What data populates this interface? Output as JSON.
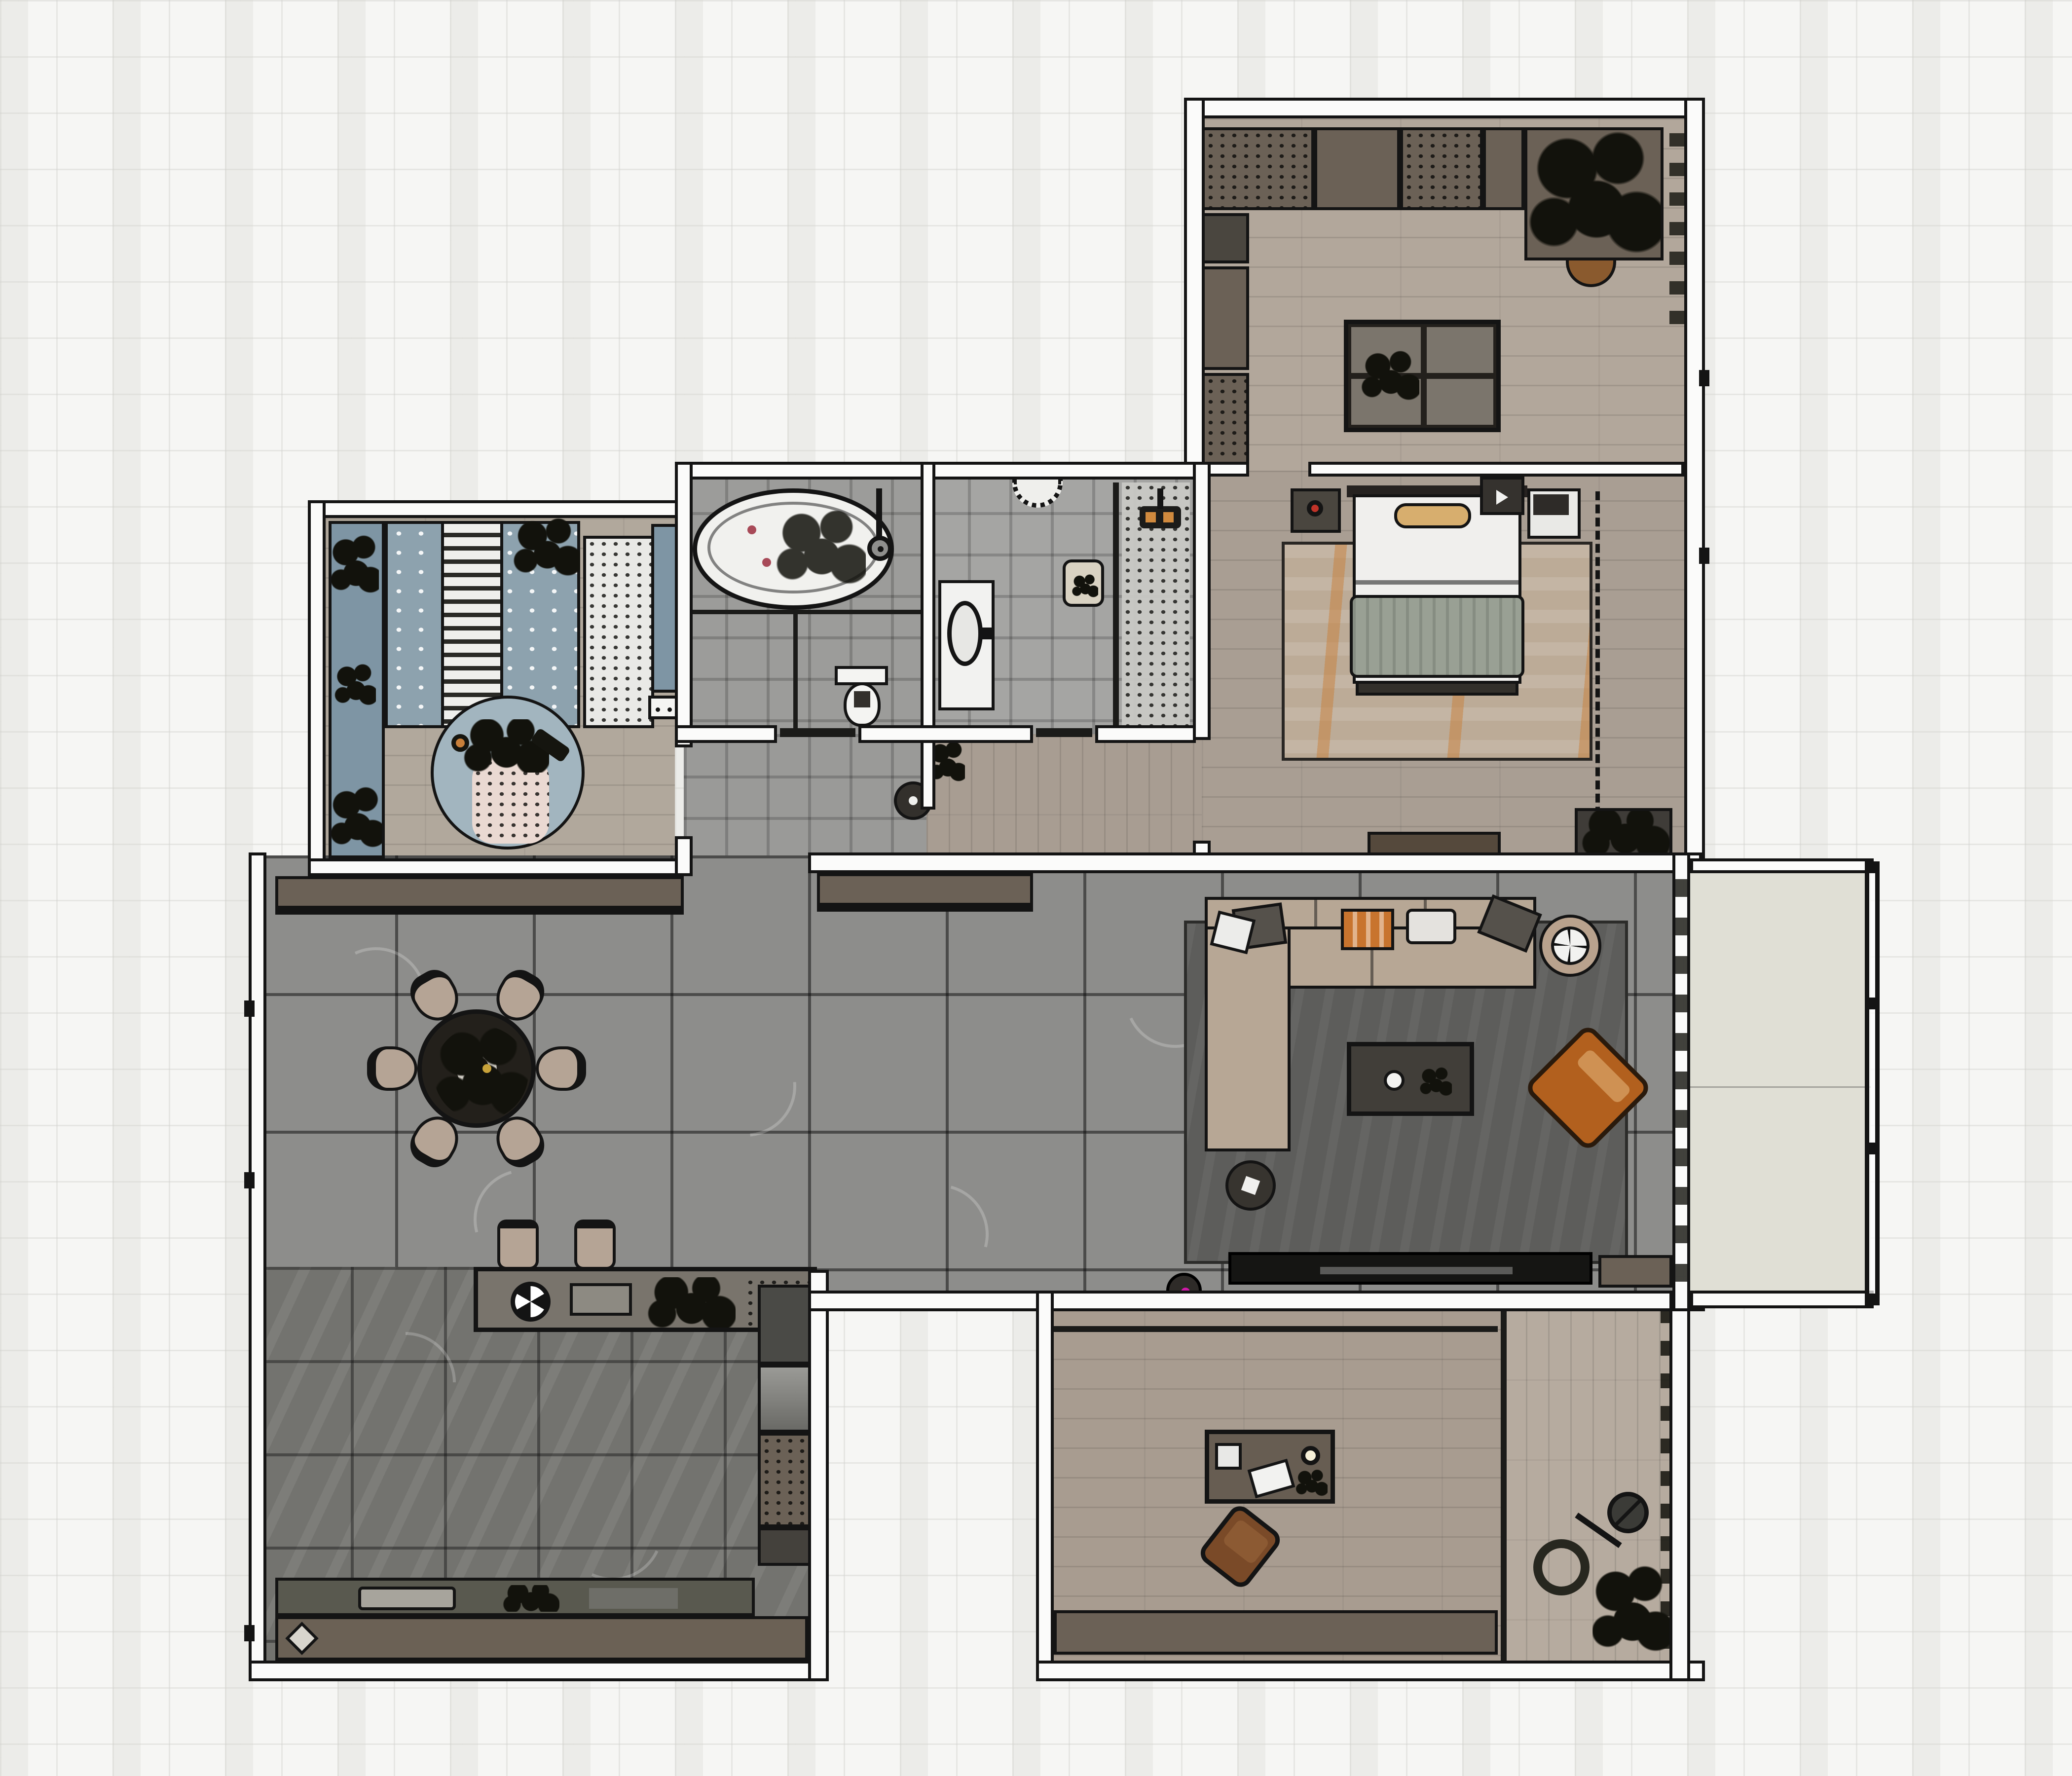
{
  "title": "apartment-floor-plan-top-view",
  "palette": {
    "background": "#f6f6f4",
    "backgroundGrid": "#e2e2de",
    "wallFill": "#fbfbfa",
    "wallLine": "#141414",
    "woodStudy": "#b2a79b",
    "woodBedroom": "#a99e93",
    "woodKids": "#b1a89c",
    "woodCorridor": "#a89d92",
    "woodTea": "#a89c90",
    "woodStrip": "#b6ab9f",
    "tileBath": "#9c9c9a",
    "tileWc": "#a5a5a3",
    "tileVestibule": "#9a9a98",
    "tileHall": "#8d8d8b",
    "tileKitchen": "#73736f",
    "balconyFloor": "#e0dfd5",
    "cabinetBrown": "#6b6156",
    "cabinetDark": "#4a463f",
    "counterTop": "#59594f",
    "counterBase": "#6b6155",
    "islandTop": "#79746c",
    "rugLiving": "#5d5d5b",
    "rugBedroom": "#bcab97",
    "rugBedroomAccent": "#c87f3a",
    "rugKids": "#a2b5bf",
    "rugKidsInner": "#ead9d2",
    "sofa": "#b7a795",
    "cushionOrange": "#c8742e",
    "cushionDark": "#55514b",
    "armchair": "#b2601e",
    "armchairCushion": "#cf9153",
    "chairTan": "#b5a495",
    "tableDark": "#23201c",
    "bedWhite": "#f0efed",
    "bedBlanket": "#99a094",
    "bedPillow": "#d7ae6e",
    "kidsBedding": "#8da2ae",
    "blueCabinet": "#7e95a4",
    "wardrobeWhite": "#e9e9e6",
    "vanityWhite": "#f2f2f0",
    "showerStrip": "#c9c9c5",
    "deskBrown": "#675d52",
    "teaChairBrown": "#7a4a28",
    "matCorner": "#3f3c38",
    "lampRed": "#c03328",
    "vacuumLight": "#d019a8",
    "tubPetal": "#a84a58",
    "planterDark": "#12120c",
    "fanDark": "#3b3b37",
    "railingLine": "#141414"
  },
  "rooms": [
    {
      "name": "study",
      "floor": "wood-plank"
    },
    {
      "name": "master-bedroom",
      "floor": "wood-plank"
    },
    {
      "name": "kids-bedroom",
      "floor": "wood-plank"
    },
    {
      "name": "bathroom",
      "floor": "gray-tile"
    },
    {
      "name": "shower-room",
      "floor": "gray-tile"
    },
    {
      "name": "vestibule",
      "floor": "gray-tile"
    },
    {
      "name": "corridor",
      "floor": "wood-plank"
    },
    {
      "name": "dining-living-hall",
      "floor": "large-gray-stone-tile"
    },
    {
      "name": "kitchen",
      "floor": "dark-marble-tile"
    },
    {
      "name": "tea-room",
      "floor": "wood-plank"
    },
    {
      "name": "side-balcony",
      "floor": "wood-plank"
    },
    {
      "name": "main-balcony",
      "floor": "plain-screed"
    }
  ],
  "furniture": {
    "study": [
      "wall-cabinets",
      "side-cabinets",
      "planter-box",
      "four-panel-table",
      "half-round-rug"
    ],
    "master_bedroom": [
      "double-bed",
      "nightstand-left",
      "nightstand-right",
      "area-rug",
      "tv-console",
      "wardrobe-dashed-front",
      "corner-mat"
    ],
    "kids_bedroom": [
      "kids-bed",
      "side-desk-strip",
      "white-wardrobe",
      "blue-cabinet",
      "round-play-rug",
      "toys"
    ],
    "bathroom": [
      "oval-bathtub",
      "shower-fixture",
      "toilet",
      "glass-partition"
    ],
    "shower_room": [
      "vanity-basin",
      "scalloped-basin",
      "bath-mat",
      "glass-partition",
      "pebble-shower-strip",
      "mixer-valves"
    ],
    "hall": [
      "sideboard-row-left",
      "sideboard-row-right",
      "round-dining-table",
      "dining-chairs-x6",
      "bar-chairs-x2",
      "kitchen-island",
      "robot-vacuum"
    ],
    "living": [
      "l-shaped-sofa",
      "cushions",
      "coffee-table",
      "orange-armchair",
      "round-side-table",
      "ring-table",
      "area-rug",
      "tv-console",
      "robot-vacuum"
    ],
    "kitchen": [
      "tall-cabinet-column",
      "worktop-row",
      "base-cabinet-row",
      "sink",
      "cooktop"
    ],
    "tea_room": [
      "low-desk",
      "speaker",
      "lamp",
      "papers",
      "lounge-chair",
      "base-cabinet-row"
    ],
    "side_balcony": [
      "standing-fan",
      "plant"
    ],
    "main_balcony": [
      "railing"
    ]
  }
}
